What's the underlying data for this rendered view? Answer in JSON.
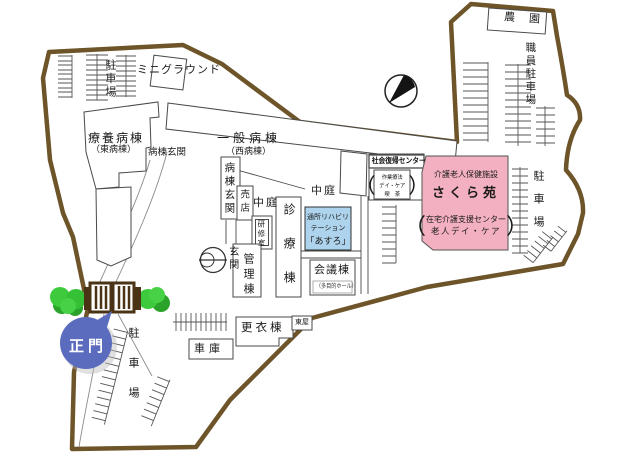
{
  "labels": {
    "parking_nw": "駐車場",
    "mini_ground": "ミニグラウンド",
    "farm": "農園",
    "staff_parking": "職員駐車場",
    "ryoyo_ward": "療養病棟",
    "ryoyo_ward_sub": "（東病棟）",
    "ward_entrance_h": "病棟玄関",
    "general_ward": "一般病棟",
    "general_ward_sub": "（西病棟）",
    "ward_entrance_v": "病棟玄関",
    "shop": "売店",
    "courtyard_1": "中庭",
    "courtyard_2": "中庭",
    "training_room": "研修室",
    "clinic_wing": "診療棟",
    "day_rehab_1": "通所リハビリ",
    "day_rehab_2": "テーション",
    "day_rehab_3": "「あすろ」",
    "entrance": "玄関",
    "admin_wing": "管理棟",
    "conference_wing": "会議棟",
    "conference_sub": "（多目的ホール）",
    "rehab_center": "社会復帰センター",
    "rehab_center_sub_1": "作業療法",
    "rehab_center_sub_2": "デイ・ケア",
    "rehab_center_sub_3": "喫　茶",
    "sakura_type": "介護老人保健施設",
    "sakura_name": "さくら苑",
    "sakura_sub_1": "在宅介護支援センター",
    "sakura_sub_2": "老人デイ・ケア",
    "paren_open": "（",
    "paren_close": "）",
    "parking_east": "駐車場",
    "main_gate": "正門",
    "changing_wing": "更衣棟",
    "gazebo": "東屋",
    "garage": "車庫",
    "parking_south": "駐車場"
  },
  "colors": {
    "boundary_brown": "#6d5429",
    "sakura_pink": "#f3b0c0",
    "day_rehab_blue": "#aed3ec",
    "gate_bubble_blue": "#5b6cbe",
    "tree_green": "#3dcb3d",
    "gate_brown": "#4a3415"
  }
}
